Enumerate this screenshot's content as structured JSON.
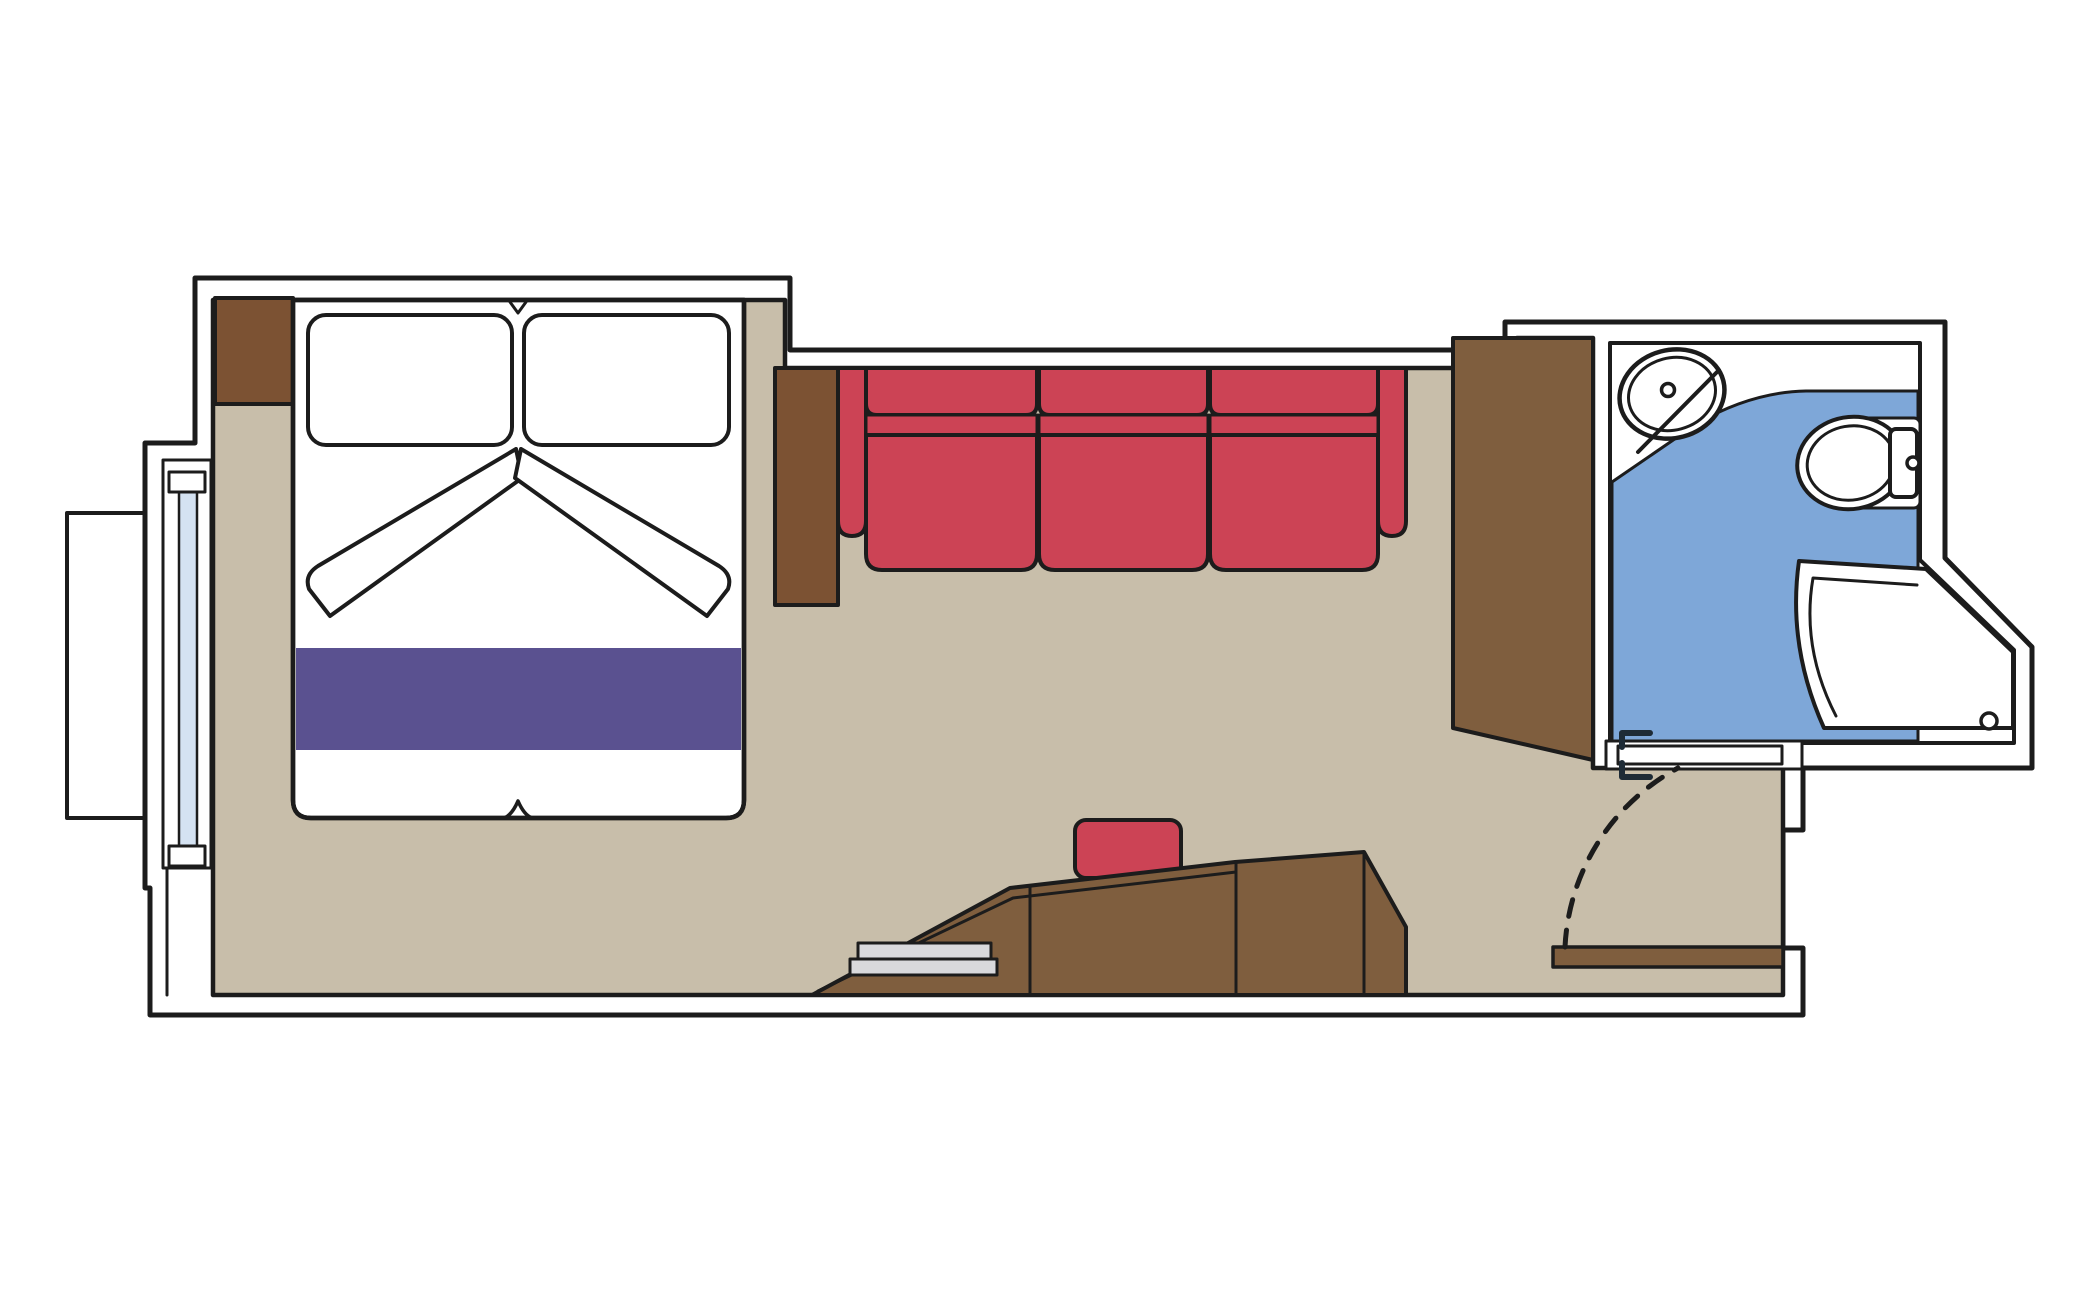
{
  "diagram": {
    "kind": "cabin-floor-plan"
  },
  "colors": {
    "background": "#ffffff",
    "wall": "#ffffff",
    "outline": "#1c1c1c",
    "floor": "#c8beaa",
    "furniture_brown": "#7f5e3e",
    "nightstand_brown": "#7c5233",
    "sofa_red": "#cc4355",
    "sofa_line": "#40151d",
    "bed_runner_purple": "#5a5190",
    "bathroom_blue": "#7ea7d8",
    "window_glass": "#d4e2f2",
    "step_gray": "#d9d9dc",
    "handle_dark": "#1e2b36",
    "linen_white": "#ffffff"
  },
  "fixtures": {
    "plan": "cabin floor plan",
    "balcony": "balcony partition",
    "window": "window",
    "bed": "double bed",
    "pillow_left": "pillow left",
    "pillow_right": "pillow right",
    "runner": "bed runner",
    "nightstand_left": "nightstand left",
    "nightstand_right": "nightstand right",
    "sofa": "three-seat sofa",
    "wardrobe": "wardrobe",
    "desk": "desk unit",
    "stool": "stool",
    "bathroom": "bathroom",
    "shower": "shower floor",
    "shower_tray": "shower tray",
    "sink": "washbasin",
    "toilet": "toilet",
    "sliding_door": "bathroom sliding door",
    "entry_door": "entry door",
    "door_swing": "door swing arc"
  }
}
